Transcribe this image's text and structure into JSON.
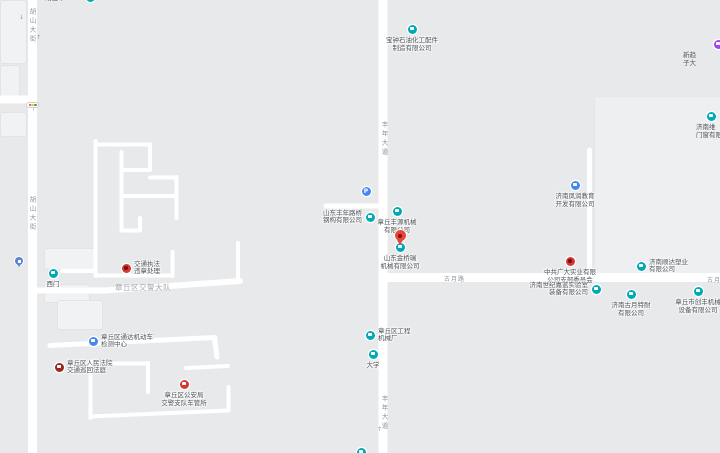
{
  "map": {
    "kind": "street-map",
    "colors": {
      "background": "#e8e9eb",
      "road": "#ffffff",
      "building": "#f1f2f3",
      "building_large": "#edeff0",
      "poi_teal": "#00a9b7",
      "poi_blue": "#4688f1",
      "poi_red": "#d7372f",
      "poi_darkred": "#96281f",
      "poi_purple": "#a142f4",
      "pin_red": "#e8453c",
      "label_text": "#4c5257",
      "road_label_text": "#8f959a",
      "area_label_text": "#a3a8ad"
    },
    "roads": {
      "hushan_street": "胡山大街",
      "fengnian_avenue": "丰年大道",
      "guyue_road": "古月路"
    },
    "area_labels": {
      "jiaojing": "章丘区交警大队"
    },
    "icons": {
      "arrow_up": "↑",
      "arrow_down": "↓",
      "parking_glyph": "P"
    },
    "pois": {
      "top_partial": {
        "line1": "胡山平"
      },
      "baozhong": {
        "line1": "宝钟石油化工配件",
        "line2": "制造有限公司"
      },
      "xinqu_partial": {
        "line1": "新趋",
        "line2": "子大"
      },
      "jinanwei_partial": {
        "line1": "济南维",
        "line2": "门窗有限"
      },
      "fengrun": {
        "line1": "济南凤润教育",
        "line2": "开发有限公司"
      },
      "fengnian_luqiao": {
        "line1": "山东丰年路桥",
        "line2": "钢构有限公司"
      },
      "fengyuan": {
        "line1": "章丘丰源机械",
        "line2": "有限公司"
      },
      "jinqiao": {
        "line1": "山东金桥瑞",
        "line2": "机械有限公司"
      },
      "zhifa": {
        "line1": "交通执法",
        "line2": "违章处理"
      },
      "ximen": {
        "line1": "西门"
      },
      "tongda": {
        "line1": "章丘区通达机动车",
        "line2": "检测中心"
      },
      "fayuan": {
        "line1": "章丘区人民法院",
        "line2": "交通巡回法庭"
      },
      "cheguansuo": {
        "line1": "章丘区公安局",
        "line2": "交警支队车管所"
      },
      "zhonggong": {
        "line1": "中共广大实业有限",
        "line2": "公司支部委员会"
      },
      "shunda": {
        "line1": "济南顺达塑业",
        "line2": "有限公司"
      },
      "shiji": {
        "line1": "济南世纪嘉蓝实验室",
        "line2": "装备有限公司"
      },
      "guyue_tenai": {
        "line1": "济南古月特耐",
        "line2": "有限公司"
      },
      "chuangfeng": {
        "line1": "章丘市创丰机械",
        "line2": "设备有限公司"
      },
      "gongcheng": {
        "line1": "章丘区工程",
        "line2": "机械厂"
      },
      "daxue": {
        "line1": "大学"
      }
    }
  }
}
